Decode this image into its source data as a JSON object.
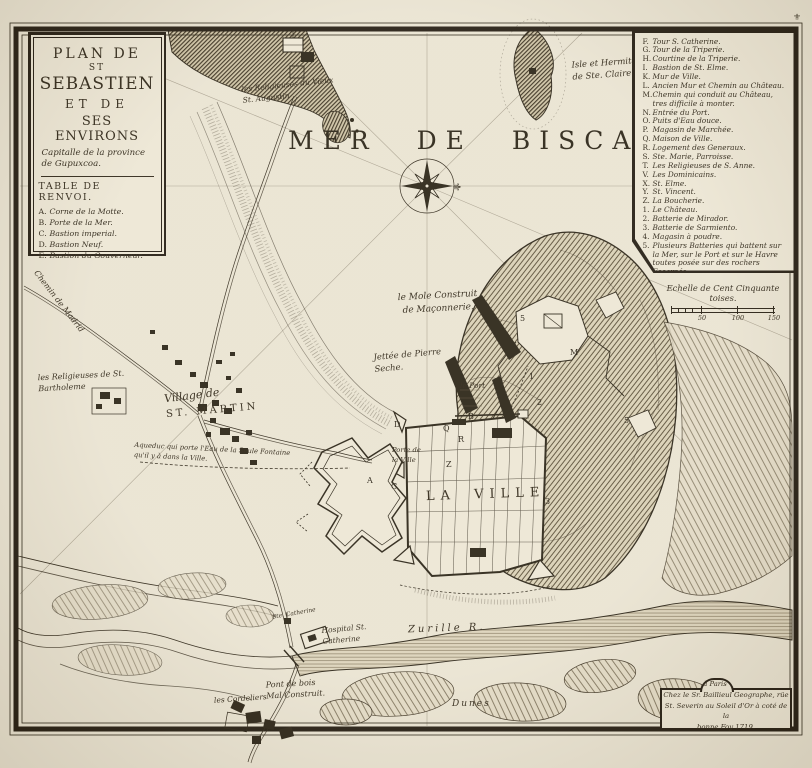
{
  "palette": {
    "paper": "#e9e3d2",
    "ink": "#241d10",
    "frame": "#1d160c",
    "hatch": "#3a3020"
  },
  "title_cartouche": {
    "title_lines": [
      "Plan de",
      "St",
      "Sebastien",
      "et de",
      "Ses Environs"
    ],
    "subtitle": "Capitalle de la province de Gupuxcoa.",
    "table_header": "Table de Renvoi.",
    "items": [
      {
        "key": "A.",
        "label": "Corne de la Motte."
      },
      {
        "key": "B.",
        "label": "Porte de la Mer."
      },
      {
        "key": "C.",
        "label": "Bastion imperial."
      },
      {
        "key": "D.",
        "label": "Bastion Neuf."
      },
      {
        "key": "E.",
        "label": "Bastion du Gouverneur."
      }
    ]
  },
  "legend": {
    "items": [
      {
        "key": "F.",
        "label": "Tour S. Catherine."
      },
      {
        "key": "G.",
        "label": "Tour de la Triperie."
      },
      {
        "key": "H.",
        "label": "Courtine de la Triperie."
      },
      {
        "key": "I.",
        "label": "Bastion de St. Elme."
      },
      {
        "key": "K.",
        "label": "Mur de Ville."
      },
      {
        "key": "L.",
        "label": "Ancien Mur et Chemin au Château."
      },
      {
        "key": "M.",
        "label": "Chemin qui conduit au Château, tres difficile à monter."
      },
      {
        "key": "N.",
        "label": "Entrée du Port."
      },
      {
        "key": "O.",
        "label": "Puits d'Eau douce."
      },
      {
        "key": "P.",
        "label": "Magasin de Marchée."
      },
      {
        "key": "Q.",
        "label": "Maison de Ville."
      },
      {
        "key": "R.",
        "label": "Logement des Generaux."
      },
      {
        "key": "S.",
        "label": "Ste. Marie, Parroisse."
      },
      {
        "key": "T.",
        "label": "Les Religieuses de S. Anne."
      },
      {
        "key": "V.",
        "label": "Les Dominicains."
      },
      {
        "key": "X.",
        "label": "St. Elme."
      },
      {
        "key": "Y.",
        "label": "St. Vincent."
      },
      {
        "key": "Z.",
        "label": "La Boucherie."
      },
      {
        "key": "1.",
        "label": "Le Château."
      },
      {
        "key": "2.",
        "label": "Batterie de Mirador."
      },
      {
        "key": "3.",
        "label": "Batterie de Sarmiento."
      },
      {
        "key": "4.",
        "label": "Magasin à poudre."
      },
      {
        "key": "5.",
        "label": "Plusieurs Batteries qui battent sur la Mer, sur le Port et sur le Havre toutes posée sur des rochers Escarpés."
      }
    ]
  },
  "scale": {
    "caption": "Echelle de Cent Cinquante toises.",
    "t50": "50",
    "t100": "100",
    "t150": "150"
  },
  "publisher": {
    "place": "à Paris",
    "line1": "Chez le Sr. Baillieul Geographe, rüe",
    "line2": "St. Severin au Soleil d'Or à coté de la",
    "line3": "bonne Foy 1719."
  },
  "sea": {
    "name": "Mer de Biscaye"
  },
  "labels": {
    "isle": "Isle et Hermitage\nde Ste. Claire",
    "vieux": "les Religieuses du Vieux\nSt. Augustin",
    "madrid": "Chemin de Madrid",
    "bartholeme": "les Religieuses de St.\nBartholeme",
    "village_prefix": "Village de",
    "village_name": "St. Martin",
    "aqueduc": "Aqueduc qui porte l'Eau de la Seule Fontaine\nqu'il y à dans la Ville.",
    "mole": "le Mole Construit\nde Maçonnerie.",
    "jettee": "Jettée de Pierre\nSeche.",
    "port": "le Port",
    "porte_ville": "Porte de\nla Ville",
    "ville": "La Ville",
    "zurille": "Zurille R.",
    "hospital": "Hospital St.\nCatherine",
    "ste_catherine": "Ste. Catherine",
    "pont": "Pont de bois\nMal Construit.",
    "cordeliers": "les Cordeliers",
    "dunes": "Dunes"
  },
  "compass": {
    "fleur": "⚜"
  },
  "corner_ornament": "⚜",
  "markers": [
    {
      "t": "A"
    },
    {
      "t": "C"
    },
    {
      "t": "B"
    },
    {
      "t": "D"
    },
    {
      "t": "Q"
    },
    {
      "t": "R"
    },
    {
      "t": "Z"
    },
    {
      "t": "1"
    },
    {
      "t": "2"
    },
    {
      "t": "5"
    },
    {
      "t": "5"
    },
    {
      "t": "M"
    },
    {
      "t": "3"
    }
  ]
}
